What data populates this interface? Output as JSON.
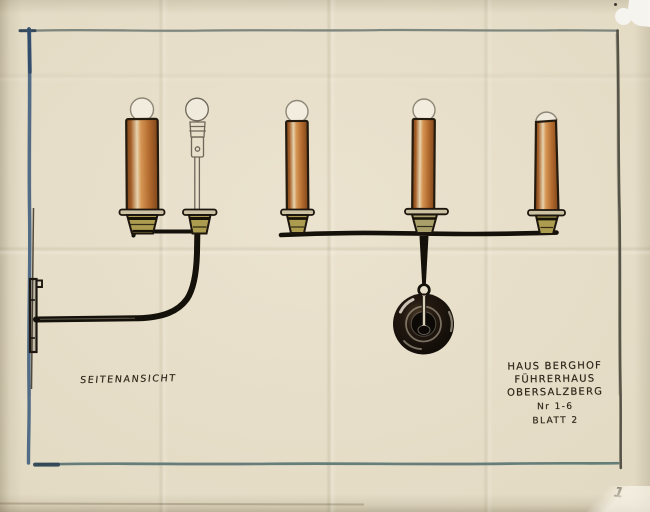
{
  "drawing": {
    "side_view_label": "SEITENANSICHT",
    "title_block": {
      "project": "HAUS BERGHOF",
      "building": "FÜHRERHAUS",
      "location": "OBERSALZBERG",
      "number": "Nr 1-6",
      "sheet": "BLATT 2"
    },
    "page_number": "1"
  },
  "colors": {
    "paper": "#e2d9c2",
    "ink": "#14100a",
    "pencil": "#8f8878",
    "candle_sleeve": "#b96f33",
    "candle_highlight": "#ecd9b4",
    "candle_shadow": "#7e451a",
    "socket_olive": "#ac9c4f",
    "border_left_blue": "#4a6583",
    "border_top_gray": "#77827a",
    "border_right_gray": "#4e4c40",
    "border_bottom_teal": "#5e7875"
  }
}
